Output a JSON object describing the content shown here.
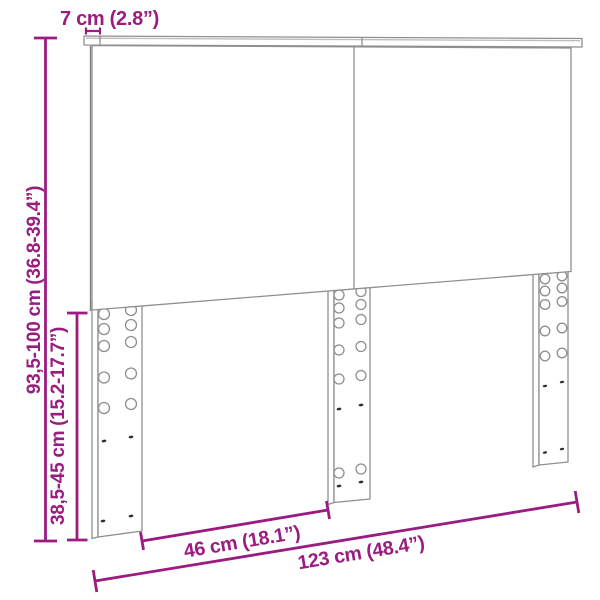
{
  "figure": {
    "kind": "product-dimension-diagram",
    "subject": "headboard-with-adjustable-legs",
    "accent_color": "#9A1C80",
    "line_color": "#8F8F8F",
    "panel_fill": "#FFFFFF",
    "background_color": "#FFFFFF"
  },
  "labels": {
    "top_bar_depth": "7 cm (2.8”)",
    "total_height_range": "93,5-100 cm (36.8-39.4”)",
    "leg_height_range": "38,5-45 cm (15.2-17.7”)",
    "leg_spacing": "46 cm (18.1”)",
    "total_width": "123 cm (48.4”)"
  }
}
